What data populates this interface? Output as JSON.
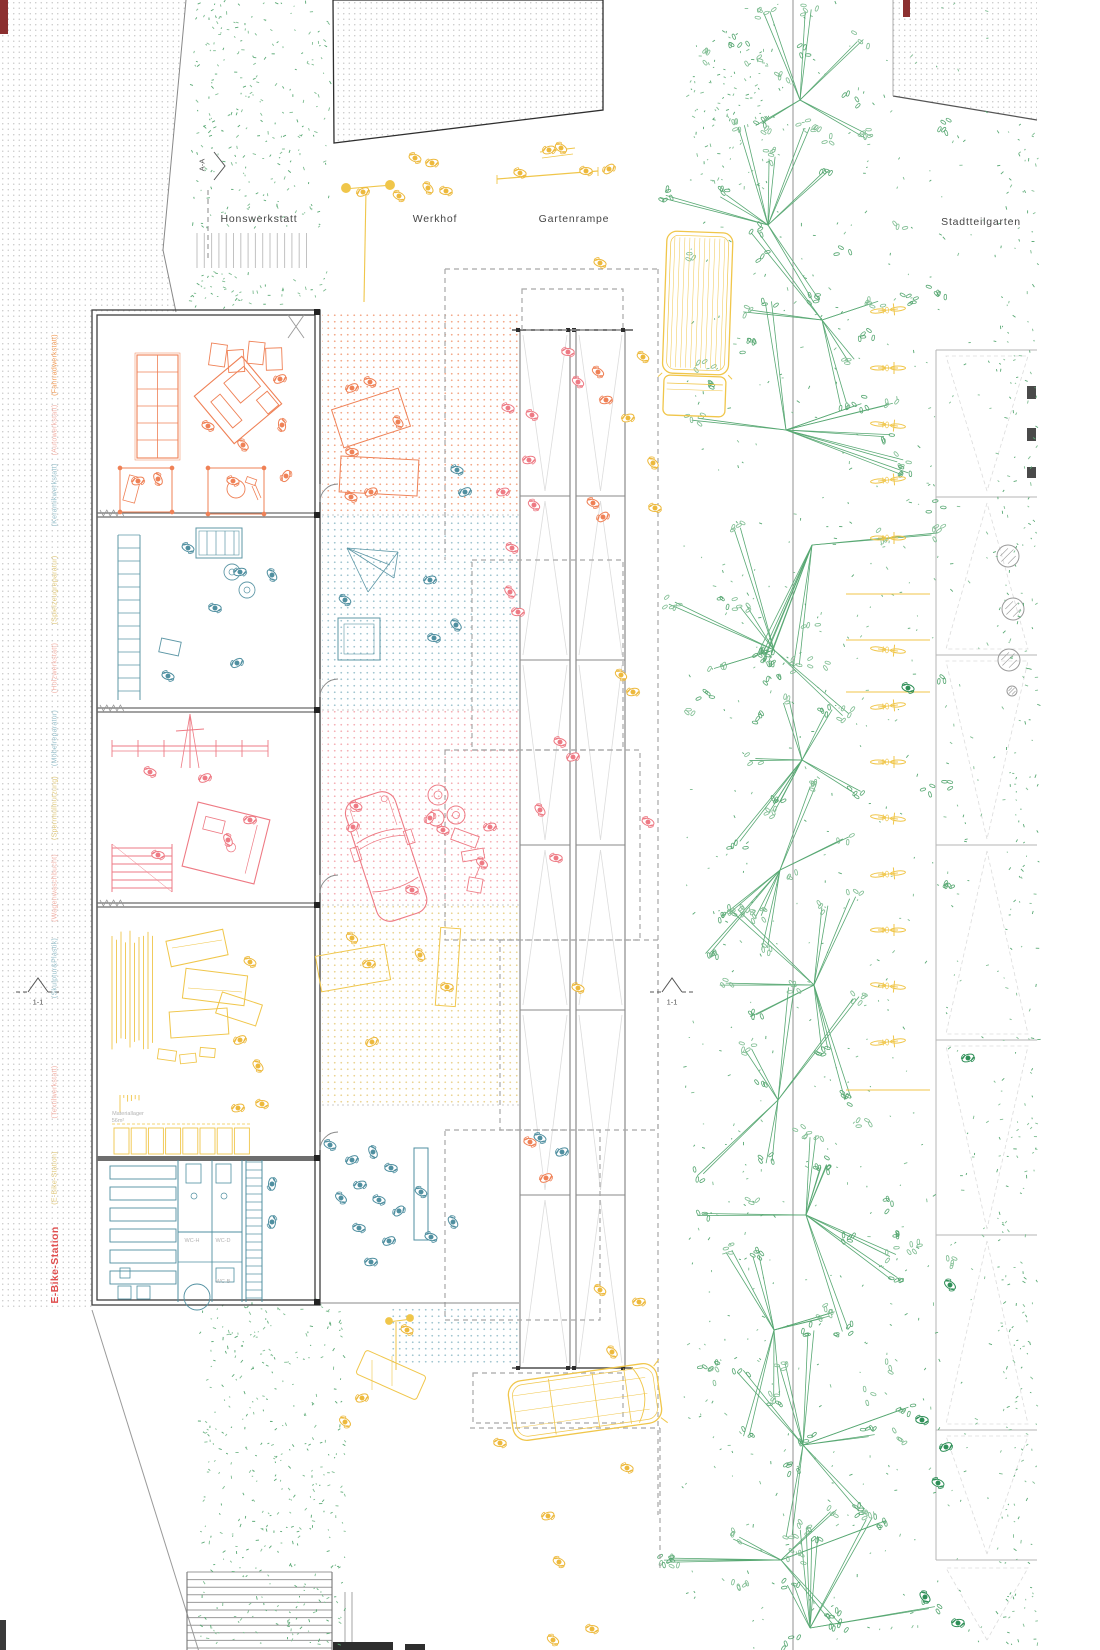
{
  "palette": {
    "orange": "#ef8156",
    "red": "#ee7a84",
    "teal": "#4f8fa0",
    "teal_room": "#5d97a6",
    "yellow": "#f0c64a",
    "yellow_deep": "#edb93c",
    "green": "#7fbd92",
    "green_mid": "#58a873",
    "green_dark": "#2e8f57",
    "wall": "#3f3f3f",
    "gray": "#9a9a9a",
    "lightgray": "#c2c2c2",
    "dash": "#a8a8a8",
    "faint": "#dcdcdc",
    "dot_gray": "#c6c6c6",
    "tint_orange": "#f3a787",
    "tint_teal": "#9fc4cf",
    "tint_pink": "#f5aeb4",
    "tint_yellow": "#ead391",
    "dark_red": "#8c3030",
    "black": "#2e2e2e",
    "lab_orange": "#f09a55",
    "lab_salmon": "#f2b3a9",
    "lab_teal": "#97bfca",
    "lab_yellow": "#e0c87c",
    "accent_red": "#e04f4f",
    "text_dark": "#454545",
    "text_gray": "#b3b3b3"
  },
  "area_labels": {
    "honswerkstatt": "Honswerkstatt",
    "werkhof": "Werkhof",
    "gartenrampe": "Gartenrampe",
    "stadtteilgarten": "Stadtteilgarten"
  },
  "section_markers": {
    "a_a": "A-A",
    "one_one_left": "1-1",
    "one_one_mid": "1-1"
  },
  "room_labels": [
    {
      "text": "(Fahrradwerkstatt)",
      "color": "lab_orange"
    },
    {
      "text": "(Autowerkstatt)",
      "color": "lab_salmon"
    },
    {
      "text": "(Keramikwerkstatt)",
      "color": "lab_teal"
    },
    {
      "text": "(Spielzeugreparatur)",
      "color": "lab_yellow"
    },
    {
      "text": "(Holzwerkstatt)",
      "color": "lab_salmon"
    },
    {
      "text": "(Möbelreparatur)",
      "color": "lab_teal"
    },
    {
      "text": "(Sperrmüllnutzung)",
      "color": "lab_yellow"
    },
    {
      "text": "(Wagenwaschbucht)",
      "color": "lab_salmon"
    },
    {
      "text": "(Skulptur&Plastik)",
      "color": "lab_teal"
    },
    {
      "text": "(Textilwerkstatt)",
      "color": "lab_salmon"
    },
    {
      "text": "(E-Bike-Station)",
      "color": "lab_yellow"
    },
    {
      "text": "E-Bike-Station",
      "color": "accent_red"
    }
  ],
  "plan_texts": {
    "materiallager": "Materiallager",
    "materiallager_area": "56m²",
    "wc_h": "WC-H",
    "wc_d": "WC-D",
    "wc_b": "WC-B"
  }
}
